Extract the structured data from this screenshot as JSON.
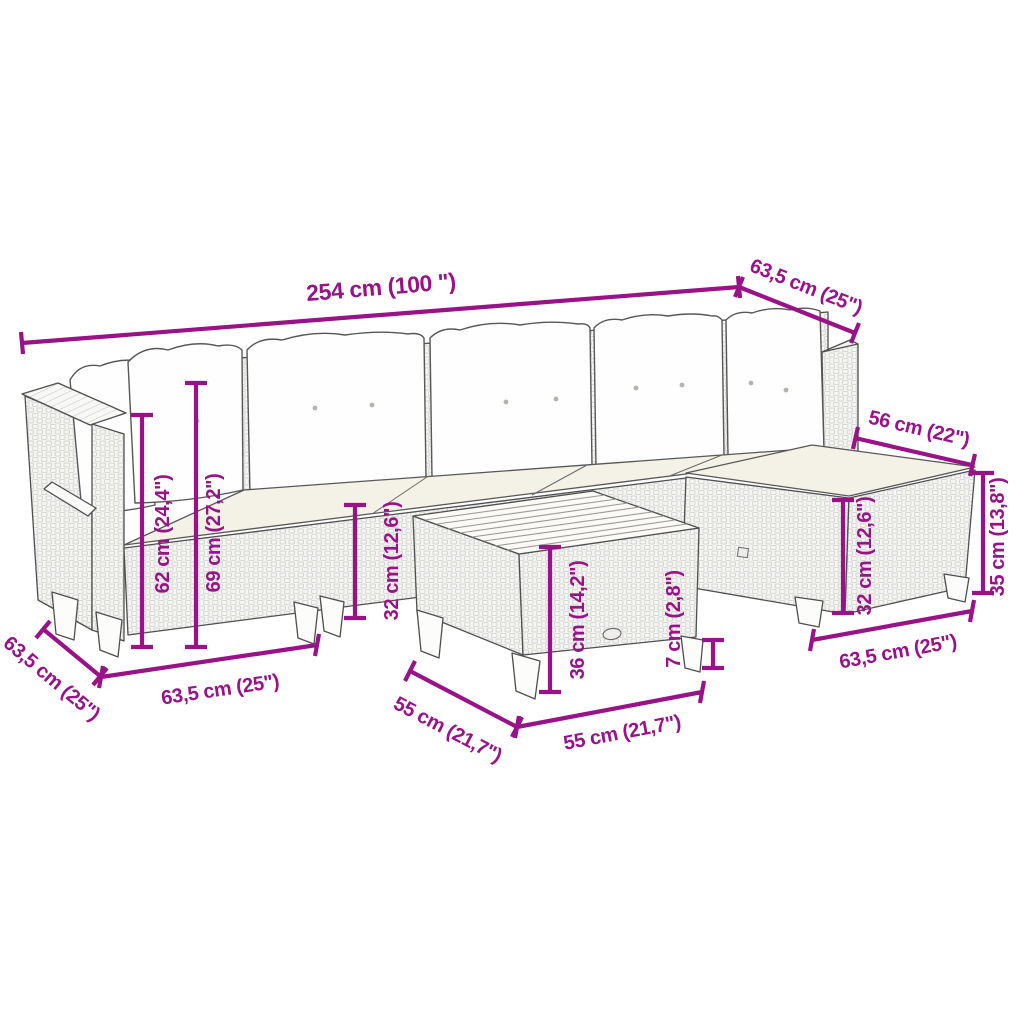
{
  "figure": {
    "kind": "product dimension diagram",
    "product": "rattan garden lounge set with corner sofa, footstool and slatted-top table"
  },
  "colors": {
    "dimension_annotation": "#991288",
    "furniture_outline": "#4f4f4f",
    "background": "#ffffff"
  },
  "dimensions": {
    "total_width": "254 cm (100 \")",
    "corner_module_depth": "63,5 cm (25\")",
    "stool_top_width": "56 cm (22\")",
    "stool_height": "35 cm (13,8\")",
    "stool_seat_height": "32 cm (12,6\")",
    "stool_base_width": "63,5 cm (25\")",
    "armrest_height": "62 cm (24,4\")",
    "back_height": "69 cm (27,2\")",
    "seat_height": "32 cm (12,6\")",
    "sofa_depth": "63,5 cm (25\")",
    "module_width": "63,5 cm (25\")",
    "table_height": "36 cm (14,2\")",
    "table_clearance": "7 cm (2,8\")",
    "table_depth": "55 cm (21,7\")",
    "table_width": "55 cm (21,7\")"
  }
}
